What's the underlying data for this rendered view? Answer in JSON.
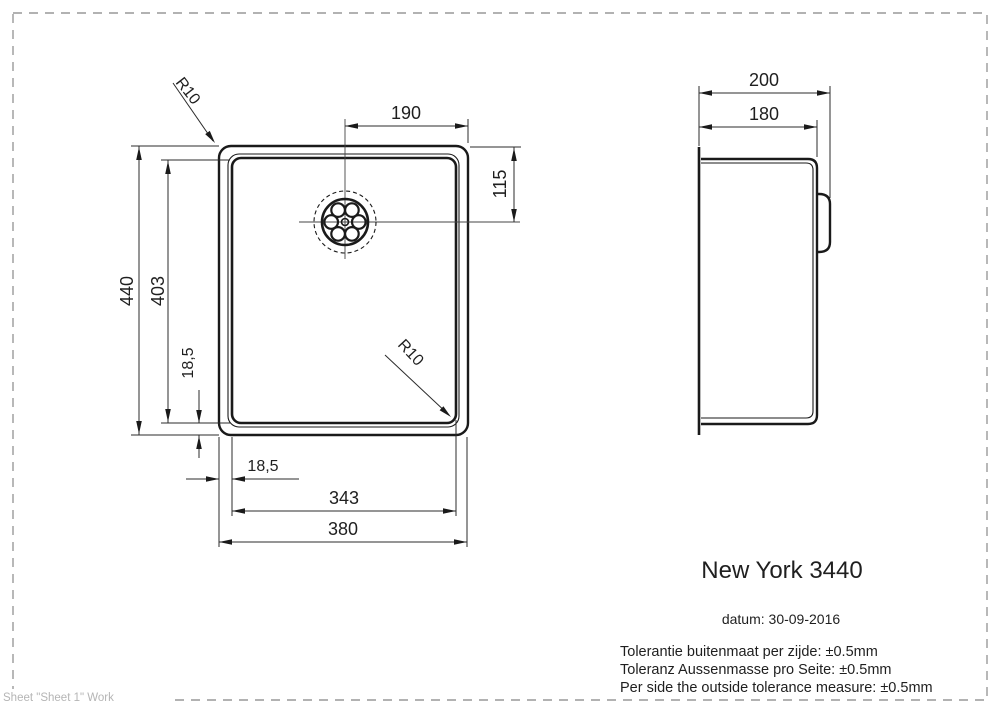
{
  "title": "New York 3440",
  "date_line": "datum: 30-09-2016",
  "tolerance_lines": [
    "Tolerantie buitenmaat per zijde: ±0.5mm",
    "Toleranz Aussenmasse pro Seite: ±0.5mm",
    "Per side the outside tolerance measure: ±0.5mm"
  ],
  "footer": "Sheet \"Sheet 1\" Work",
  "dims": {
    "top_width": "190",
    "drain_offset": "115",
    "outer_height": "440",
    "inner_height": "403",
    "rim_left": "18,5",
    "rim_bottom": "18,5",
    "inner_width": "343",
    "outer_width": "380",
    "side_outer_depth": "200",
    "side_inner_depth": "180",
    "corner_radius_top": "R10",
    "corner_radius_bottom": "R10"
  },
  "colors": {
    "drawing_line": "#1a1a1a",
    "dimension_line": "#2b2b2b",
    "sheet_border": "#999999",
    "footer_text": "#b5b5b5"
  }
}
